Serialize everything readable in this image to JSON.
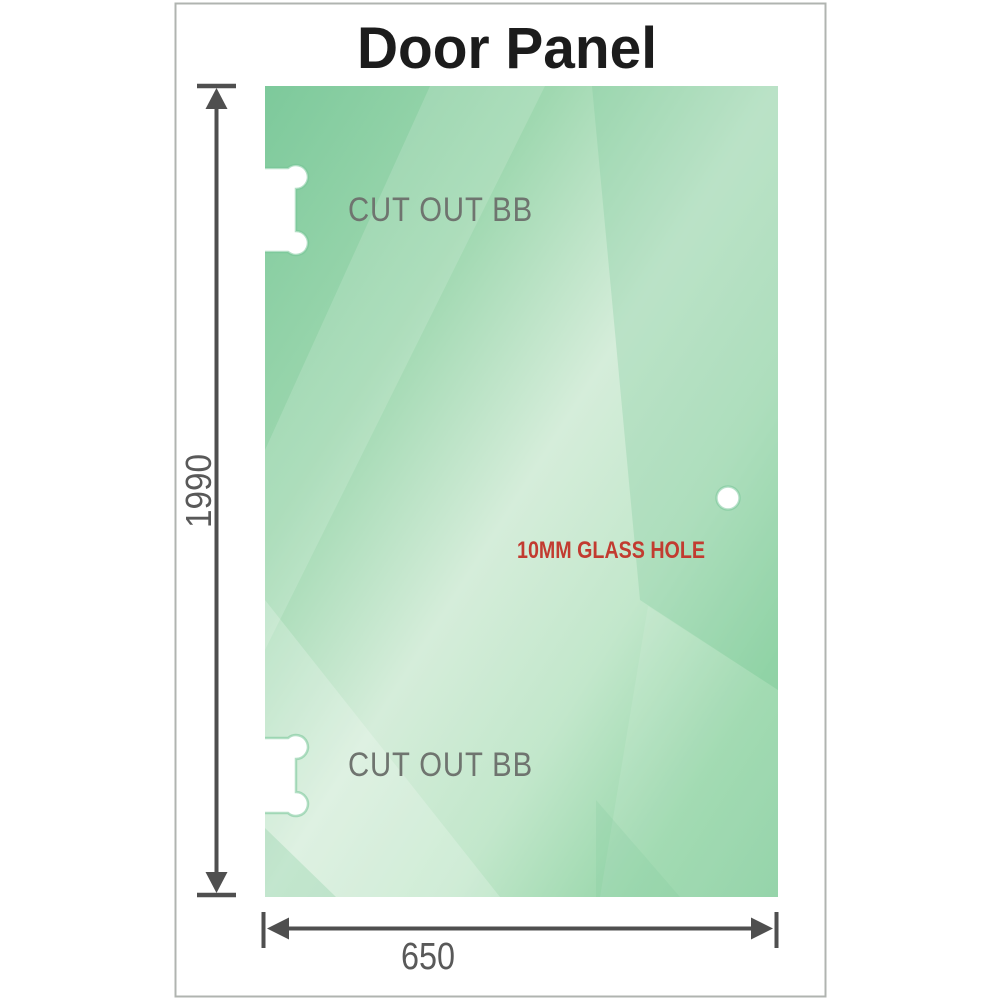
{
  "title": "Door Panel",
  "panel": {
    "cutout_top_label": "CUT OUT BB",
    "cutout_bottom_label": "CUT OUT BB",
    "hole_label": "10MM GLASS HOLE"
  },
  "dimensions": {
    "height": "1990",
    "width": "650"
  },
  "colors": {
    "title_text": "#1c1c1c",
    "dimension_line": "#4f4f4f",
    "dimension_text": "#595959",
    "cutout_label_gray": "#6f746f",
    "hole_note_red": "#c23b30",
    "frame_border": "#b0b4b0",
    "glass_1": "#7dc99b",
    "glass_2": "#9fd8b0",
    "glass_3": "#d5edda",
    "glass_4": "#c2e7cb",
    "glass_5": "#99d7ab",
    "glass_6": "#8ad0a1",
    "cutout_fill": "#ffffff",
    "cutout_edge": "#74c496",
    "reflection_white": "#ffffff"
  }
}
